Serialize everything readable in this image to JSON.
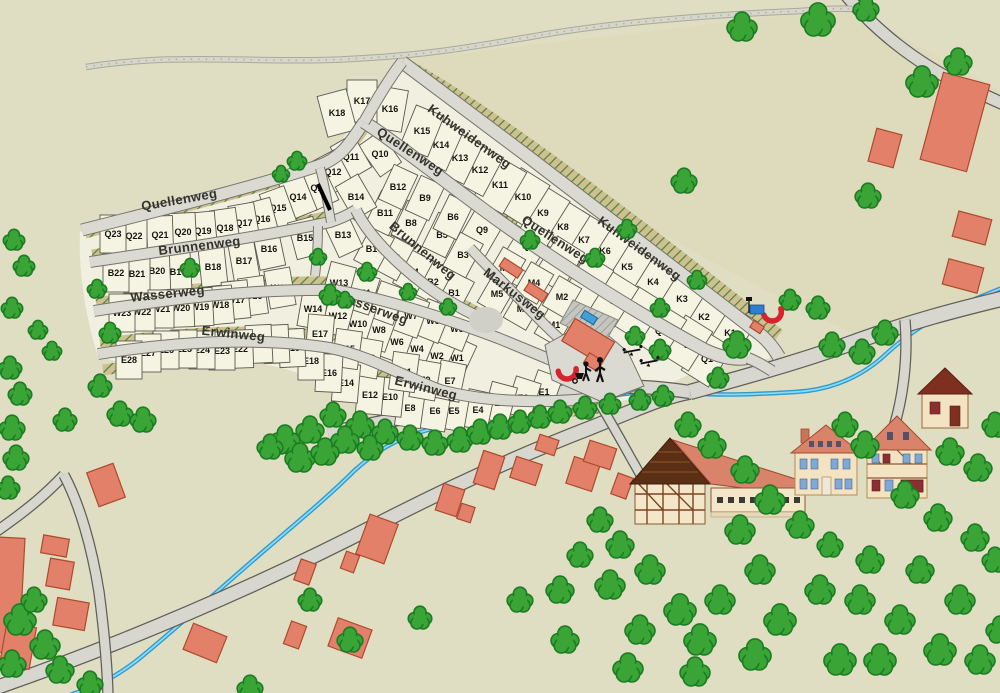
{
  "map": {
    "background_color": "#dfdec2",
    "colors": {
      "parcel_fill": "#f5f3e2",
      "parcel_stroke": "#5a594f",
      "street_fill": "#dadad3",
      "street_casing": "#74746c",
      "village_road_fill": "#d7d7d0",
      "village_road_casing": "#5f5f57",
      "hull_fill": "#f1efdf",
      "band_fill": "#cdc193",
      "band_hatch": "#55812d",
      "tree_fill": "#3aa536",
      "tree_stroke": "#1b7c22",
      "building_fill": "#e2806a",
      "building_stroke": "#ad4a2d",
      "stream_color": "#2b9bd0",
      "marker_arc_color": "#d6232e",
      "bus_sign_color": "#2f7fd1",
      "pool_color": "#3f9fd8"
    },
    "streets": [
      {
        "name": "Quellenweg",
        "labels": [
          {
            "x": 180,
            "y": 204,
            "r": -10
          },
          {
            "x": 408,
            "y": 155,
            "r": 33
          },
          {
            "x": 553,
            "y": 243,
            "r": 33
          }
        ]
      },
      {
        "name": "Kuhweidenweg",
        "labels": [
          {
            "x": 467,
            "y": 140,
            "r": 36
          },
          {
            "x": 637,
            "y": 252,
            "r": 36
          }
        ]
      },
      {
        "name": "Brunnenweg",
        "labels": [
          {
            "x": 200,
            "y": 250,
            "r": -7
          },
          {
            "x": 420,
            "y": 254,
            "r": 40
          }
        ]
      },
      {
        "name": "Wasserweg",
        "labels": [
          {
            "x": 168,
            "y": 298,
            "r": -6
          },
          {
            "x": 371,
            "y": 312,
            "r": 20
          }
        ]
      },
      {
        "name": "Erwinweg",
        "labels": [
          {
            "x": 233,
            "y": 338,
            "r": 6
          },
          {
            "x": 425,
            "y": 392,
            "r": 14
          }
        ]
      },
      {
        "name": "Markusweg",
        "labels": [
          {
            "x": 512,
            "y": 297,
            "r": 38
          }
        ]
      }
    ],
    "parcels": [
      [
        "K1",
        730,
        333,
        32,
        34,
        48
      ],
      [
        "K2",
        704,
        317,
        32,
        34,
        48
      ],
      [
        "K3",
        682,
        299,
        32,
        34,
        48
      ],
      [
        "K4",
        653,
        282,
        32,
        34,
        48
      ],
      [
        "K5",
        627,
        267,
        32,
        34,
        48
      ],
      [
        "K6",
        605,
        251,
        32,
        34,
        48
      ],
      [
        "K7",
        584,
        240,
        32,
        34,
        48
      ],
      [
        "K8",
        563,
        227,
        32,
        34,
        48
      ],
      [
        "K9",
        543,
        213,
        32,
        34,
        48
      ],
      [
        "K10",
        523,
        197,
        32,
        34,
        48
      ],
      [
        "K11",
        500,
        185,
        30,
        34,
        48
      ],
      [
        "K12",
        480,
        170,
        28,
        30,
        44
      ],
      [
        "K13",
        460,
        158,
        26,
        30,
        44
      ],
      [
        "K14",
        441,
        145,
        24,
        30,
        44
      ],
      [
        "K15",
        422,
        131,
        22,
        30,
        44
      ],
      [
        "K16",
        390,
        109,
        10,
        30,
        42
      ],
      [
        "K17",
        362,
        101,
        0,
        30,
        42
      ],
      [
        "K18",
        337,
        113,
        -15,
        30,
        42
      ],
      [
        "Q1",
        707,
        359,
        32,
        32,
        46
      ],
      [
        "Q2",
        687,
        343,
        32,
        32,
        46
      ],
      [
        "Q3",
        661,
        331,
        32,
        32,
        46
      ],
      [
        "Q4",
        639,
        314,
        32,
        32,
        46
      ],
      [
        "Q5",
        613,
        299,
        32,
        32,
        46
      ],
      [
        "Q6",
        588,
        282,
        32,
        32,
        46
      ],
      [
        "Q7",
        559,
        264,
        32,
        32,
        46
      ],
      [
        "Q8",
        528,
        246,
        32,
        32,
        46
      ],
      [
        "Q9",
        482,
        230,
        30,
        32,
        46
      ],
      [
        "Q10",
        380,
        154,
        -35
      ],
      [
        "Q11",
        351,
        157,
        -30
      ],
      [
        "Q12",
        333,
        172,
        -28
      ],
      [
        "Q13",
        319,
        188,
        -25
      ],
      [
        "Q14",
        298,
        197,
        -22
      ],
      [
        "Q15",
        278,
        208,
        -20
      ],
      [
        "Q16",
        262,
        219,
        -15
      ],
      [
        "Q17",
        244,
        223,
        -10
      ],
      [
        "Q18",
        225,
        228,
        -8
      ],
      [
        "Q19",
        203,
        231,
        -5
      ],
      [
        "Q20",
        183,
        232,
        -3
      ],
      [
        "Q21",
        160,
        235,
        -2
      ],
      [
        "Q22",
        134,
        236,
        0
      ],
      [
        "Q23",
        113,
        234,
        0
      ],
      [
        "B1",
        454,
        293,
        28
      ],
      [
        "B2",
        433,
        282,
        28
      ],
      [
        "B3",
        463,
        255,
        28
      ],
      [
        "B4",
        413,
        272,
        28
      ],
      [
        "B5",
        442,
        235,
        26
      ],
      [
        "B6",
        453,
        217,
        26
      ],
      [
        "B7",
        394,
        258,
        28
      ],
      [
        "B8",
        411,
        223,
        26
      ],
      [
        "B9",
        425,
        198,
        25
      ],
      [
        "B10",
        374,
        249,
        28
      ],
      [
        "B11",
        385,
        213,
        26
      ],
      [
        "B12",
        398,
        187,
        25
      ],
      [
        "B13",
        343,
        235,
        -25
      ],
      [
        "B14",
        356,
        197,
        -30
      ],
      [
        "B15",
        305,
        238,
        -15
      ],
      [
        "B16",
        269,
        249,
        -12
      ],
      [
        "B17",
        244,
        261,
        -10
      ],
      [
        "B18",
        213,
        267,
        -6
      ],
      [
        "B19",
        178,
        272,
        -3
      ],
      [
        "B20",
        157,
        271,
        -2
      ],
      [
        "B21",
        137,
        274,
        0
      ],
      [
        "B22",
        116,
        273,
        0
      ],
      [
        "W1",
        457,
        358,
        25
      ],
      [
        "W2",
        437,
        356,
        25
      ],
      [
        "W3",
        457,
        329,
        22
      ],
      [
        "W4",
        417,
        349,
        22
      ],
      [
        "W5",
        433,
        321,
        22
      ],
      [
        "W6",
        397,
        342,
        20
      ],
      [
        "W7",
        411,
        316,
        20
      ],
      [
        "W8",
        379,
        330,
        20
      ],
      [
        "W9",
        387,
        303,
        20
      ],
      [
        "W10",
        358,
        324,
        18
      ],
      [
        "W11",
        362,
        293,
        18
      ],
      [
        "W12",
        338,
        316,
        15
      ],
      [
        "W13",
        339,
        283,
        15
      ],
      [
        "W14",
        313,
        309,
        10
      ],
      [
        "W15",
        280,
        288,
        -10
      ],
      [
        "W16",
        253,
        296,
        -8
      ],
      [
        "W17",
        236,
        300,
        -6
      ],
      [
        "W18",
        220,
        305,
        -5
      ],
      [
        "W19",
        200,
        307,
        -3
      ],
      [
        "W20",
        181,
        308,
        -2
      ],
      [
        "W21",
        161,
        309,
        0
      ],
      [
        "W22",
        142,
        312,
        0
      ],
      [
        "W23",
        122,
        313,
        0
      ],
      [
        "E1",
        544,
        392,
        20
      ],
      [
        "E2",
        523,
        398,
        18
      ],
      [
        "E3",
        500,
        403,
        15
      ],
      [
        "E4",
        478,
        410,
        12
      ],
      [
        "E5",
        454,
        411,
        10
      ],
      [
        "E6",
        435,
        411,
        10
      ],
      [
        "E7",
        450,
        381,
        12
      ],
      [
        "E8",
        410,
        408,
        8
      ],
      [
        "E9",
        425,
        380,
        10
      ],
      [
        "E10",
        390,
        397,
        6
      ],
      [
        "E11",
        404,
        372,
        8
      ],
      [
        "E12",
        370,
        395,
        5
      ],
      [
        "E13",
        367,
        358,
        10
      ],
      [
        "E14",
        346,
        383,
        5
      ],
      [
        "E15",
        347,
        349,
        8
      ],
      [
        "E16",
        329,
        373,
        3
      ],
      [
        "E17",
        320,
        334,
        5
      ],
      [
        "E18",
        311,
        361,
        0
      ],
      [
        "E19",
        292,
        348,
        -3
      ],
      [
        "E20",
        276,
        344,
        -3
      ],
      [
        "E21",
        259,
        344,
        -3
      ],
      [
        "E22",
        240,
        349,
        -2
      ],
      [
        "E23",
        222,
        351,
        0
      ],
      [
        "E24",
        202,
        350,
        0
      ],
      [
        "E25",
        184,
        349,
        0
      ],
      [
        "E26",
        166,
        350,
        0
      ],
      [
        "E27",
        148,
        353,
        0
      ],
      [
        "E28",
        129,
        360,
        0
      ],
      [
        "M1",
        554,
        325,
        30,
        26,
        34
      ],
      [
        "M2",
        562,
        297,
        30,
        26,
        34
      ],
      [
        "M3",
        523,
        309,
        30,
        26,
        34
      ],
      [
        "M4",
        534,
        283,
        30,
        26,
        34
      ],
      [
        "M5",
        497,
        294,
        30,
        26,
        34
      ],
      [
        "M6",
        506,
        268,
        30,
        26,
        34
      ]
    ],
    "trees": [
      [
        14,
        240,
        10
      ],
      [
        24,
        266,
        10
      ],
      [
        12,
        308,
        10
      ],
      [
        38,
        330,
        9
      ],
      [
        10,
        368,
        11
      ],
      [
        20,
        394,
        11
      ],
      [
        12,
        428,
        12
      ],
      [
        16,
        458,
        12
      ],
      [
        8,
        488,
        11
      ],
      [
        97,
        289,
        9
      ],
      [
        110,
        333,
        10
      ],
      [
        52,
        351,
        9
      ],
      [
        100,
        386,
        11
      ],
      [
        65,
        420,
        11
      ],
      [
        120,
        414,
        12
      ],
      [
        143,
        420,
        12
      ],
      [
        297,
        161,
        9
      ],
      [
        281,
        174,
        8
      ],
      [
        190,
        268,
        9
      ],
      [
        330,
        295,
        10
      ],
      [
        367,
        272,
        9
      ],
      [
        318,
        257,
        8
      ],
      [
        345,
        300,
        8
      ],
      [
        408,
        292,
        8
      ],
      [
        448,
        307,
        8
      ],
      [
        530,
        240,
        9
      ],
      [
        595,
        258,
        9
      ],
      [
        627,
        229,
        9
      ],
      [
        660,
        308,
        9
      ],
      [
        697,
        280,
        9
      ],
      [
        635,
        336,
        9
      ],
      [
        660,
        350,
        10
      ],
      [
        737,
        345,
        13
      ],
      [
        718,
        378,
        10
      ],
      [
        333,
        415,
        12
      ],
      [
        360,
        425,
        13
      ],
      [
        385,
        432,
        12
      ],
      [
        410,
        438,
        12
      ],
      [
        435,
        443,
        12
      ],
      [
        460,
        440,
        12
      ],
      [
        480,
        432,
        12
      ],
      [
        500,
        427,
        12
      ],
      [
        520,
        422,
        11
      ],
      [
        540,
        417,
        11
      ],
      [
        560,
        412,
        11
      ],
      [
        585,
        408,
        11
      ],
      [
        610,
        404,
        10
      ],
      [
        640,
        400,
        10
      ],
      [
        663,
        396,
        10
      ],
      [
        345,
        440,
        13
      ],
      [
        310,
        430,
        13
      ],
      [
        285,
        440,
        14
      ],
      [
        300,
        458,
        14
      ],
      [
        325,
        452,
        13
      ],
      [
        270,
        447,
        12
      ],
      [
        370,
        448,
        12
      ],
      [
        688,
        425,
        12
      ],
      [
        712,
        445,
        13
      ],
      [
        745,
        470,
        13
      ],
      [
        770,
        500,
        14
      ],
      [
        740,
        530,
        14
      ],
      [
        800,
        525,
        13
      ],
      [
        600,
        520,
        12
      ],
      [
        620,
        545,
        13
      ],
      [
        580,
        555,
        12
      ],
      [
        560,
        590,
        13
      ],
      [
        610,
        585,
        14
      ],
      [
        650,
        570,
        14
      ],
      [
        680,
        610,
        15
      ],
      [
        640,
        630,
        14
      ],
      [
        700,
        640,
        15
      ],
      [
        720,
        600,
        14
      ],
      [
        760,
        570,
        14
      ],
      [
        780,
        620,
        15
      ],
      [
        820,
        590,
        14
      ],
      [
        840,
        660,
        15
      ],
      [
        860,
        600,
        14
      ],
      [
        880,
        660,
        15
      ],
      [
        900,
        620,
        14
      ],
      [
        920,
        570,
        13
      ],
      [
        940,
        650,
        15
      ],
      [
        960,
        600,
        14
      ],
      [
        980,
        660,
        14
      ],
      [
        1000,
        630,
        13
      ],
      [
        995,
        560,
        12
      ],
      [
        870,
        560,
        13
      ],
      [
        830,
        545,
        12
      ],
      [
        755,
        655,
        15
      ],
      [
        695,
        672,
        14
      ],
      [
        628,
        668,
        14
      ],
      [
        565,
        640,
        13
      ],
      [
        520,
        600,
        12
      ],
      [
        790,
        300,
        10
      ],
      [
        818,
        308,
        11
      ],
      [
        885,
        333,
        12
      ],
      [
        862,
        352,
        12
      ],
      [
        832,
        345,
        12
      ],
      [
        845,
        425,
        12
      ],
      [
        865,
        445,
        13
      ],
      [
        950,
        452,
        13
      ],
      [
        978,
        468,
        13
      ],
      [
        995,
        425,
        12
      ],
      [
        905,
        495,
        13
      ],
      [
        938,
        518,
        13
      ],
      [
        975,
        538,
        13
      ],
      [
        742,
        27,
        14
      ],
      [
        818,
        20,
        16
      ],
      [
        866,
        9,
        12
      ],
      [
        922,
        82,
        15
      ],
      [
        958,
        62,
        13
      ],
      [
        684,
        181,
        12
      ],
      [
        868,
        196,
        12
      ],
      [
        20,
        620,
        15
      ],
      [
        45,
        645,
        14
      ],
      [
        12,
        664,
        13
      ],
      [
        60,
        670,
        13
      ],
      [
        90,
        684,
        12
      ],
      [
        34,
        600,
        12
      ],
      [
        310,
        600,
        11
      ],
      [
        350,
        640,
        12
      ],
      [
        250,
        688,
        12
      ],
      [
        420,
        618,
        11
      ]
    ],
    "buildings": [
      [
        955,
        122,
        48,
        90,
        15
      ],
      [
        885,
        148,
        26,
        34,
        15
      ],
      [
        972,
        228,
        34,
        26,
        15
      ],
      [
        963,
        276,
        36,
        26,
        15
      ],
      [
        5,
        595,
        34,
        115,
        3
      ],
      [
        106,
        485,
        28,
        36,
        -20
      ],
      [
        55,
        546,
        26,
        18,
        10
      ],
      [
        60,
        574,
        24,
        28,
        10
      ],
      [
        18,
        646,
        30,
        42,
        10
      ],
      [
        71,
        614,
        32,
        28,
        10
      ],
      [
        377,
        539,
        30,
        42,
        20
      ],
      [
        350,
        562,
        14,
        18,
        20
      ],
      [
        305,
        572,
        16,
        22,
        20
      ],
      [
        350,
        638,
        36,
        30,
        20
      ],
      [
        295,
        635,
        16,
        24,
        20
      ],
      [
        205,
        643,
        36,
        28,
        22
      ],
      [
        450,
        500,
        22,
        28,
        18
      ],
      [
        466,
        513,
        14,
        16,
        18
      ],
      [
        489,
        470,
        22,
        34,
        18
      ],
      [
        526,
        471,
        27,
        22,
        18
      ],
      [
        547,
        445,
        20,
        16,
        18
      ],
      [
        583,
        474,
        27,
        28,
        18
      ],
      [
        600,
        455,
        28,
        22,
        18
      ],
      [
        511,
        268,
        22,
        10,
        33
      ],
      [
        536,
        292,
        22,
        10,
        33
      ],
      [
        757,
        327,
        12,
        8,
        33
      ],
      [
        622,
        486,
        16,
        22,
        20
      ]
    ]
  }
}
